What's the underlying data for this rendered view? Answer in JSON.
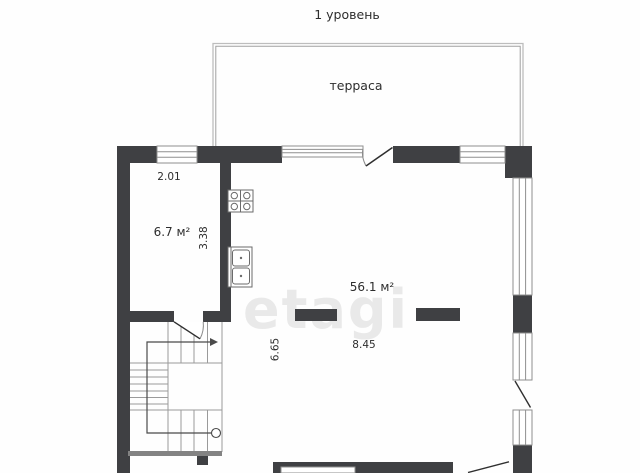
{
  "page": {
    "title": "1 уровень"
  },
  "watermark": {
    "text": "etagi"
  },
  "plan": {
    "terrace": {
      "label": "терраса"
    },
    "rooms": [
      {
        "id": "kitchen",
        "area": "6.7 м²",
        "width": "2.01",
        "depth": "3.38"
      },
      {
        "id": "living-room",
        "area": "56.1 м²",
        "width": "8.45",
        "depth": "6.65"
      }
    ],
    "features": [
      "terrace",
      "stairs-up-icon",
      "stove-icon",
      "sink-icon",
      "window",
      "door-swing"
    ],
    "colors": {
      "wall": "#3f4043",
      "outline": "#8f8f8f",
      "stair_line": "#9a9a9a",
      "text": "#2d2d2d",
      "watermark": "#e9e9e9",
      "background": "#fefefe"
    }
  }
}
